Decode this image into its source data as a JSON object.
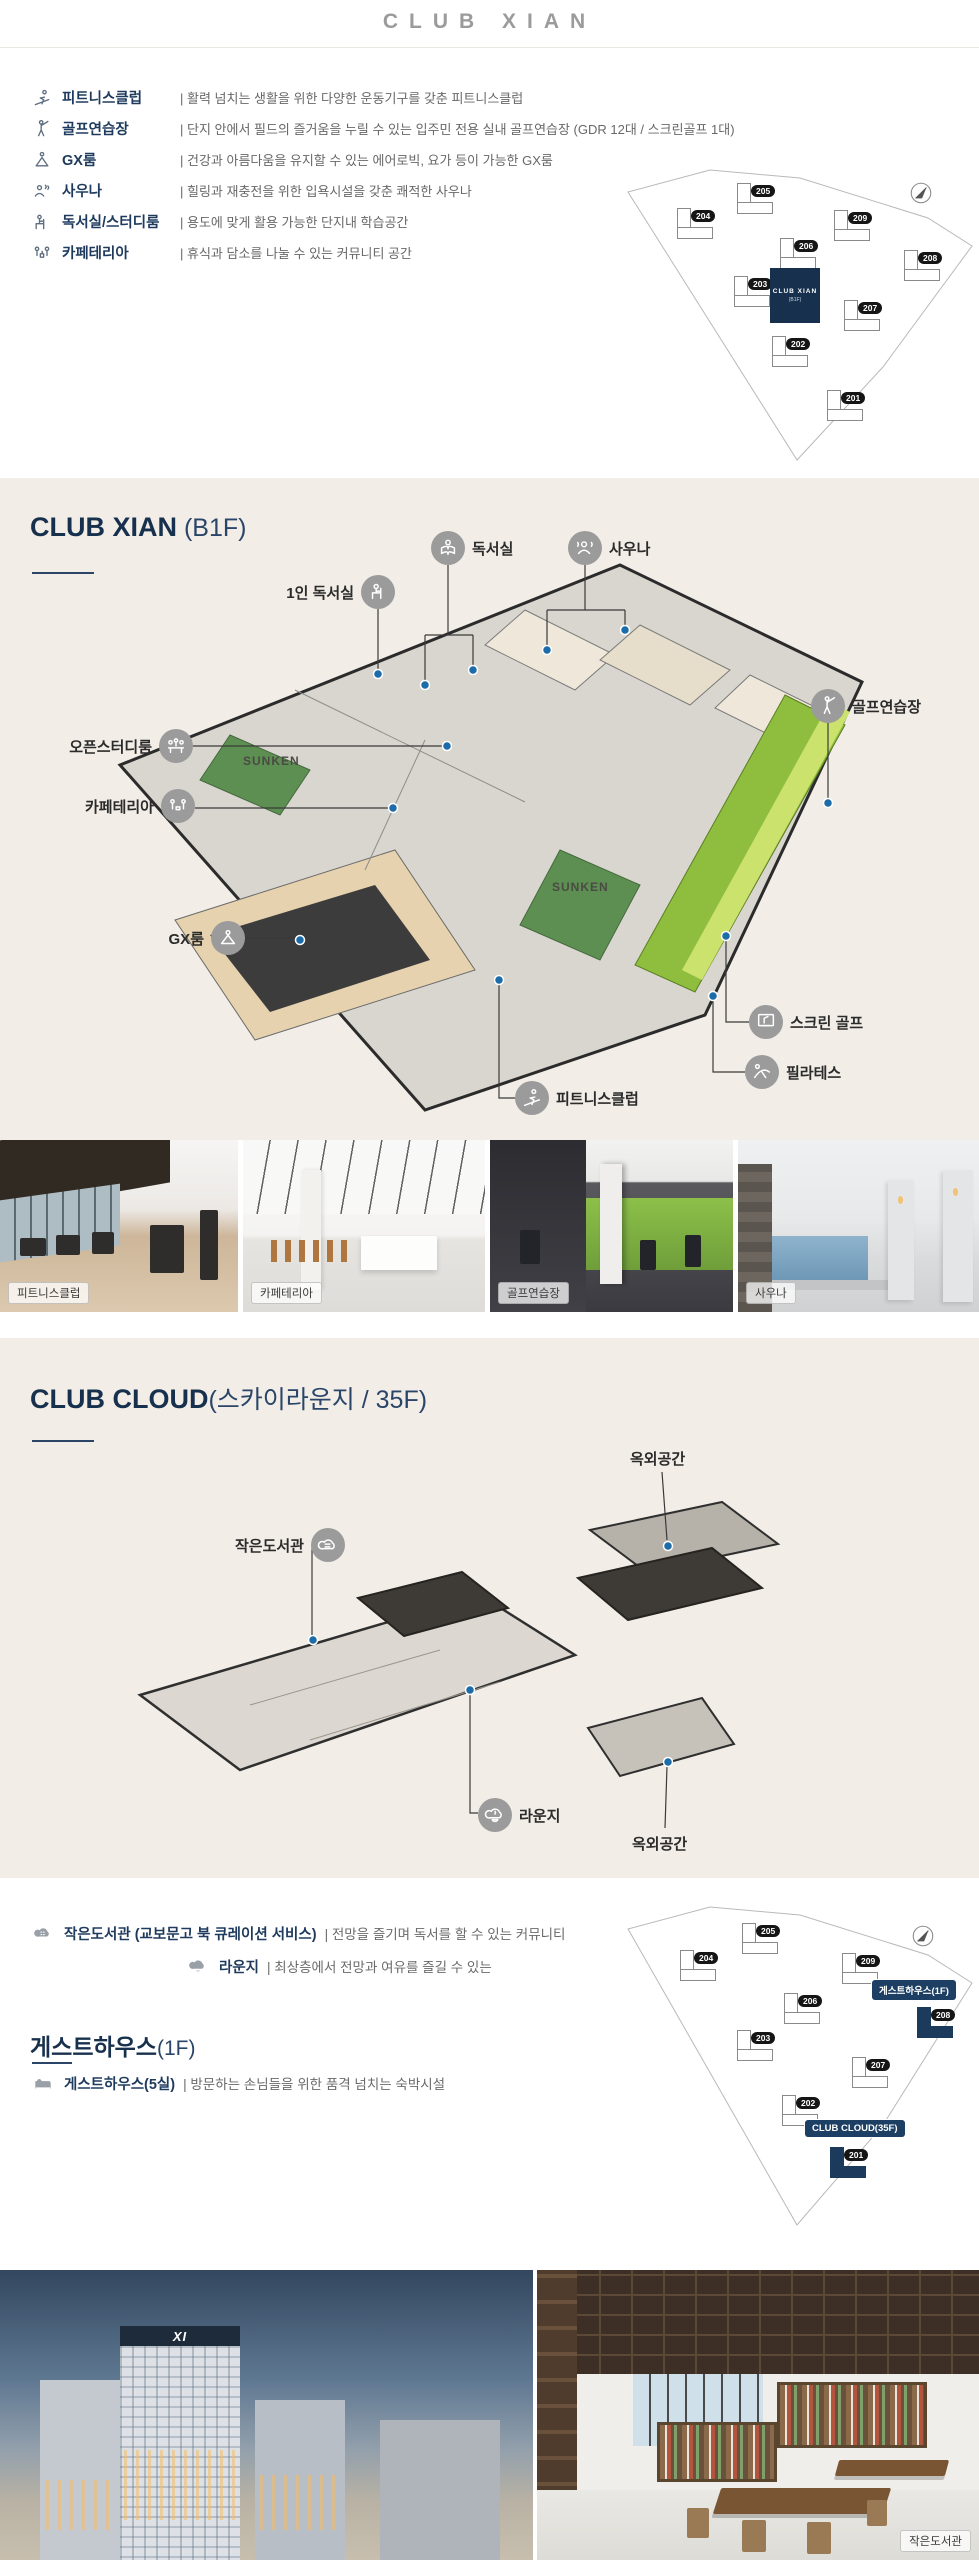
{
  "header": {
    "title": "CLUB XIAN"
  },
  "amenities": [
    {
      "icon": "fitness-icon",
      "label": "피트니스클럽",
      "desc": "| 활력 넘치는 생활을 위한 다양한 운동기구를 갖춘 피트니스클럽"
    },
    {
      "icon": "golf-icon",
      "label": "골프연습장",
      "desc": "| 단지 안에서 필드의 즐거움을 누릴 수 있는 입주민 전용 실내 골프연습장 (GDR 12대 / 스크린골프 1대)"
    },
    {
      "icon": "yoga-icon",
      "label": "GX룸",
      "desc": "| 건강과 아름다움을 유지할 수 있는 에어로빅, 요가 등이 가능한 GX룸"
    },
    {
      "icon": "sauna-icon",
      "label": "사우나",
      "desc": "| 힐링과 재충전을 위한 입욕시설을 갖춘 쾌적한 사우나"
    },
    {
      "icon": "study-icon",
      "label": "독서실/스터디룸",
      "desc": "| 용도에 맞게 활용 가능한 단지내 학습공간"
    },
    {
      "icon": "cafe-icon",
      "label": "카페테리아",
      "desc": "| 휴식과 담소를 나눌 수 있는 커뮤니티 공간"
    }
  ],
  "sitemap_xian": {
    "buildings": [
      "205",
      "204",
      "209",
      "206",
      "208",
      "203",
      "207",
      "202",
      "201"
    ],
    "club_label": "CLUB XIAN",
    "club_sub": "(B1F)"
  },
  "section_b1f": {
    "title": "CLUB XIAN",
    "suffix": " (B1F)",
    "labels": {
      "reading_room": "독서실",
      "sauna": "사우나",
      "single_reading": "1인 독서실",
      "open_study": "오픈스터디룸",
      "cafeteria": "카페테리아",
      "gx_room": "GX룸",
      "golf_range": "골프연습장",
      "screen_golf": "스크린 골프",
      "pilates": "필라테스",
      "fitness": "피트니스클럽",
      "sunken": "SUNKEN"
    }
  },
  "photos": {
    "fitness": "피트니스클럽",
    "cafeteria": "카페테리아",
    "golf": "골프연습장",
    "sauna": "사우나"
  },
  "section_cloud": {
    "title": "CLUB CLOUD",
    "suffix": "(스카이라운지 / 35F)",
    "labels": {
      "outdoor_top": "옥외공간",
      "library": "작은도서관",
      "lounge": "라운지",
      "outdoor_bottom": "옥외공간"
    }
  },
  "info": {
    "library_label": "작은도서관 (교보문고 북 큐레이션 서비스)",
    "library_desc": "| 전망을 즐기며 독서를 할 수 있는 커뮤니티",
    "lounge_label": "라운지",
    "lounge_desc": "| 최상층에서 전망과 여유를 즐길 수 있는",
    "guesthouse_title": "게스트하우스",
    "guesthouse_suffix": "(1F)",
    "guesthouse_label": "게스트하우스(5실)",
    "guesthouse_desc": "| 방문하는 손님들을 위한 품격 넘치는 숙박시설"
  },
  "sitemap_guest": {
    "buildings": [
      "205",
      "204",
      "209",
      "206",
      "208",
      "203",
      "207",
      "202",
      "201"
    ],
    "badge_guesthouse": "게스트하우스(1F)",
    "badge_cloud": "CLUB CLOUD(35F)"
  },
  "bottom": {
    "logo": "XI",
    "library_caption": "작은도서관"
  },
  "colors": {
    "navy": "#16304d",
    "beige": "#f2eee7",
    "green": "#8fbe3f"
  }
}
